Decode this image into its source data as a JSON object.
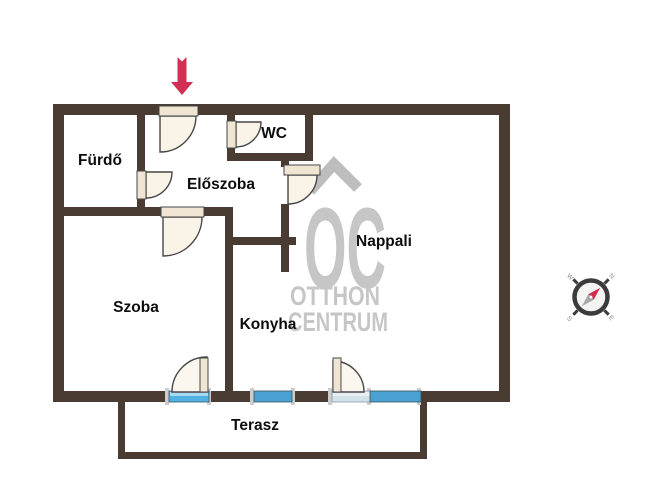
{
  "rooms": {
    "furdo": {
      "label": "Fürdő"
    },
    "wc": {
      "label": "WC"
    },
    "eloszoba": {
      "label": "Előszoba"
    },
    "nappali": {
      "label": "Nappali"
    },
    "szoba": {
      "label": "Szoba"
    },
    "konyha": {
      "label": "Konyha"
    },
    "terasz": {
      "label": "Terasz"
    }
  },
  "watermark": {
    "monogram": "OC",
    "line1": "OTTHON",
    "line2": "CENTRUM"
  },
  "compass": {
    "north": "N",
    "east": "E",
    "south": "S",
    "west": "W"
  },
  "colors": {
    "wall": "#4a3c32",
    "terrace_wall": "#4a3c32",
    "window_blue": "#4aa0d2",
    "door_sill_light_blue": "#52b1e3",
    "door_sill_pale": "#d3e1e8",
    "door_fill": "#faf3e7",
    "door_panel": "#efe5d2",
    "entrance_arrow_red": "#d13054",
    "watermark_gray": "#c4c4c4",
    "compass_needle_red": "#d02c50",
    "compass_needle_gray": "#a8a8a8"
  }
}
